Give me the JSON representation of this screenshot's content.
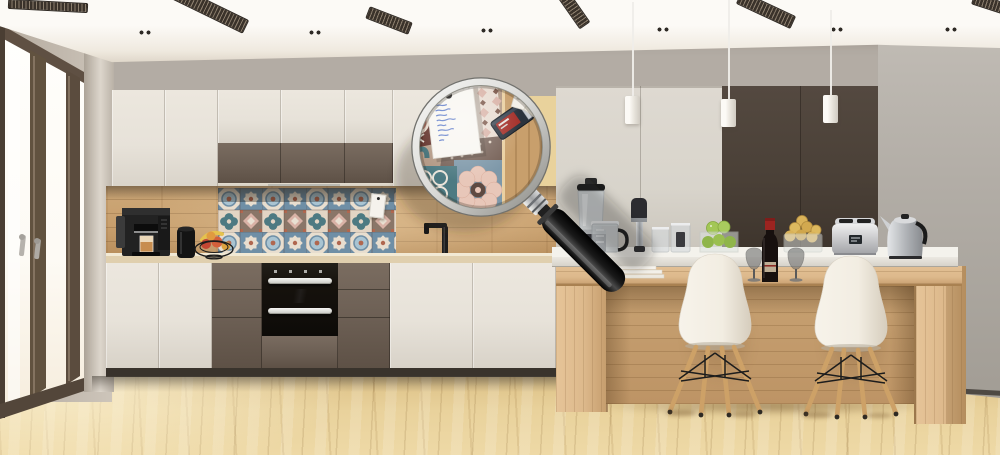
{
  "scene": {
    "description": "3D render of a modern beige-and-brown kitchen; a large magnifying glass enlarges the patchwork-tile backsplash with a pinned handwritten shopping note, price tags and a tape measure",
    "objects": [
      "ceiling slot vents",
      "recessed spotlights",
      "french window",
      "pendant lights",
      "upper cabinets",
      "tall cabinets",
      "patchwork tile backsplash",
      "wood backsplash",
      "black faucet",
      "built-in double oven",
      "coffee machine",
      "black canister",
      "fruit basket",
      "kitchen island",
      "bar chairs",
      "blender",
      "measuring jug",
      "hand blender",
      "storage jars",
      "apple vase",
      "wine glasses",
      "wine bottle",
      "fruit bowl",
      "toaster",
      "kettle",
      "magnifying glass",
      "shopping note",
      "price tags",
      "tape measure"
    ]
  },
  "magnifier": {
    "note_legible": false,
    "note_line_count": 8,
    "pin_color": "#161616"
  },
  "colors": {
    "ceiling": "#efe9df",
    "wallStrip": "#b3aca4",
    "wallLeft": "#c1b8ad",
    "wallRight": "#b2ada6",
    "windowFrame": "#5f5043",
    "windowGlass": "#fefcf8",
    "cabWhite": "#e7e2d9",
    "cabBrown": "#6d6055",
    "tallLight": "#d8d4cb",
    "tallDark": "#4a4037",
    "woodWall": "#c79e6c",
    "counterTop": "#e0cfae",
    "ovenBlack": "#16120d",
    "steel": "#c6c8ca",
    "islandWood": "#ddb98c",
    "islandRecess": "#c7a172",
    "floorWood": "#e9d29c",
    "chairShell": "#f2ede2",
    "chairLeg": "#cda167",
    "pendantWhite": "#e9e5dd",
    "lensRim": "#d9d9d6",
    "handleBlack": "#161616",
    "noteInk": "#5b79c8",
    "tileBlue": "#6f8fa6",
    "tileCream": "#e8decf",
    "tileTeal": "#4d7a82",
    "tileRust": "#b0674f",
    "tileMaroon": "#5e2c25",
    "tilePink": "#d9b2a6"
  }
}
